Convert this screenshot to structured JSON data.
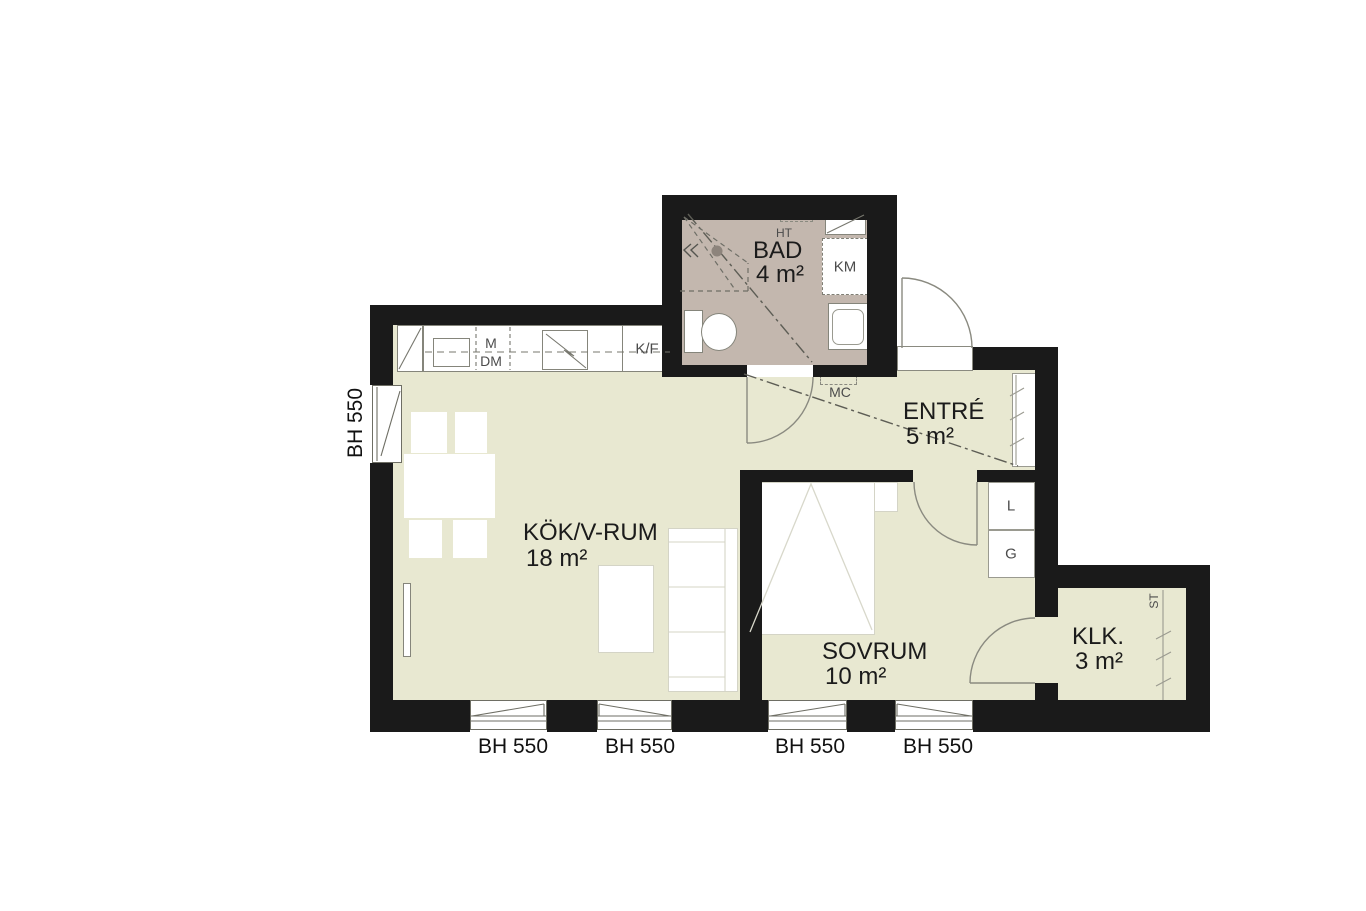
{
  "plan_type": "apartment-floor-plan",
  "rooms": {
    "bad": {
      "name": "BAD",
      "area": "4 m²"
    },
    "entre": {
      "name": "ENTRÉ",
      "area": "5 m²"
    },
    "kok": {
      "name": "KÖK/V-RUM",
      "area": "18 m²"
    },
    "sovrum": {
      "name": "SOVRUM",
      "area": "10 m²"
    },
    "klk": {
      "name": "KLK.",
      "area": "3 m²"
    }
  },
  "fixture_labels": {
    "ht": "HT",
    "km": "KM",
    "mc": "MC",
    "m": "M",
    "dm": "DM",
    "kf": "K/F",
    "l": "L",
    "g": "G",
    "st": "ST"
  },
  "window_labels": {
    "left": "BH 550",
    "w1": "BH 550",
    "w2": "BH 550",
    "w3": "BH 550",
    "w4": "BH 550"
  },
  "colors": {
    "floor": "#e8e8d1",
    "bathroom_floor": "#c3b7ae",
    "wall": "#1a1a1a",
    "background": "#ffffff"
  }
}
